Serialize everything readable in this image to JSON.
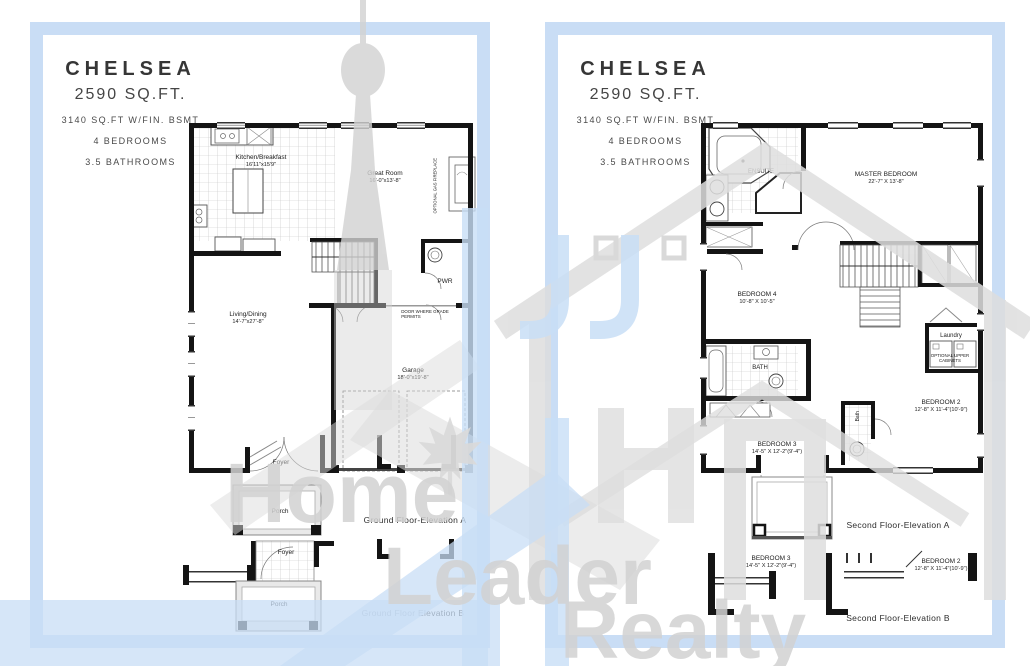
{
  "colors": {
    "panel_border": "#c9ddf5",
    "wall": "#141414",
    "watermark_gray": "#d7d7d7",
    "watermark_blue": "#c8def6",
    "porch_fill": "#e9e9e9"
  },
  "watermark": {
    "word1": "Home",
    "word2": "Leader",
    "word3": "Realty"
  },
  "header": {
    "title": "CHELSEA",
    "sqft": "2590 SQ.FT.",
    "bsmt": "3140 SQ.FT W/FIN. BSMT",
    "beds": "4 BEDROOMS",
    "baths": "3.5 BATHROOMS"
  },
  "ground": {
    "kitchen_name": "Kitchen/Breakfast",
    "kitchen_dims": "16'11\"x15'9\"",
    "great_name": "Great Room",
    "great_dims": "16'-0\"x13'-8\"",
    "pwr": "PWR",
    "door_note1": "DOOR WHERE GRADE",
    "door_note2": "PERMITS",
    "living_name": "Living/Dining",
    "living_dims": "14'-7\"x27'-8\"",
    "garage_name": "Garage",
    "garage_dims": "18'-0\"x19'-8\"",
    "foyer": "Foyer",
    "porch": "Porch",
    "fireplace_note": "OPTIONAL GAS FIREPLACE",
    "elev_a": "Ground Floor-Elevation A",
    "elev_b": "Ground Floor Elevation B"
  },
  "second": {
    "ensuite": "ENSUITE",
    "master_name": "MASTER BEDROOM",
    "master_dims": "22'-7\" X 13'-8\"",
    "bed4_name": "BEDROOM 4",
    "bed4_dims": "10'-8\" X 10'-5\"",
    "bath": "BATH",
    "laundry": "Laundry",
    "cab1": "OPTIONAL UPPER",
    "cab2": "CABINETS",
    "bath2": "Bath",
    "bed2_name": "BEDROOM 2",
    "bed2_dims": "12'-8\" X 11'-4\"(10'-9\")",
    "bed3_name": "BEDROOM 3",
    "bed3_dims": "14'-5\" X 12'-2\"(9'-4\")",
    "elev_a": "Second Floor-Elevation A",
    "elev_b": "Second Floor-Elevation B"
  }
}
